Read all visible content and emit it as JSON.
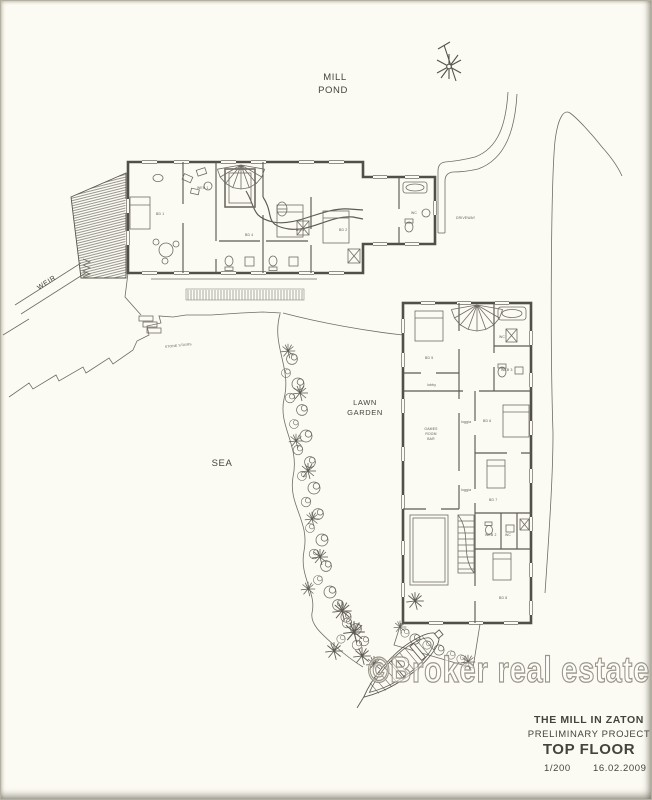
{
  "site": {
    "mill_pond": [
      "MILL",
      "POND"
    ],
    "weir": "WEIR",
    "sea": "SEA",
    "lawn_garden": [
      "LAWN",
      "GARDEN"
    ],
    "driveway": "DRIVEWAY",
    "stone_stairs": "STONE STAIRS"
  },
  "buildings": {
    "top": {
      "rooms": [
        {
          "label": "BD 1"
        },
        {
          "label": "WEB 1"
        },
        {
          "label": "BD 4"
        },
        {
          "label": "BD 3"
        },
        {
          "label": "BD 2"
        },
        {
          "label": "WC"
        }
      ]
    },
    "right": {
      "rooms": [
        {
          "label": "BD 5"
        },
        {
          "label": "WC"
        },
        {
          "label": "WEB 3"
        },
        {
          "label": "lobby"
        },
        {
          "label": "GAMES"
        },
        {
          "label": "ROOM"
        },
        {
          "label": "BAR"
        },
        {
          "label": "loggia"
        },
        {
          "label": "BD 6"
        },
        {
          "label": "loggia"
        },
        {
          "label": "BD 7"
        },
        {
          "label": "WEB 2"
        },
        {
          "label": "WC"
        },
        {
          "label": "BD 8"
        }
      ]
    }
  },
  "watermark": "©Broker real estate",
  "title_block": {
    "project": "THE MILL IN ZATON",
    "phase": "PRELIMINARY PROJECT",
    "sheet": "TOP FLOOR",
    "scale": "1/200",
    "date": "16.02.2009"
  }
}
